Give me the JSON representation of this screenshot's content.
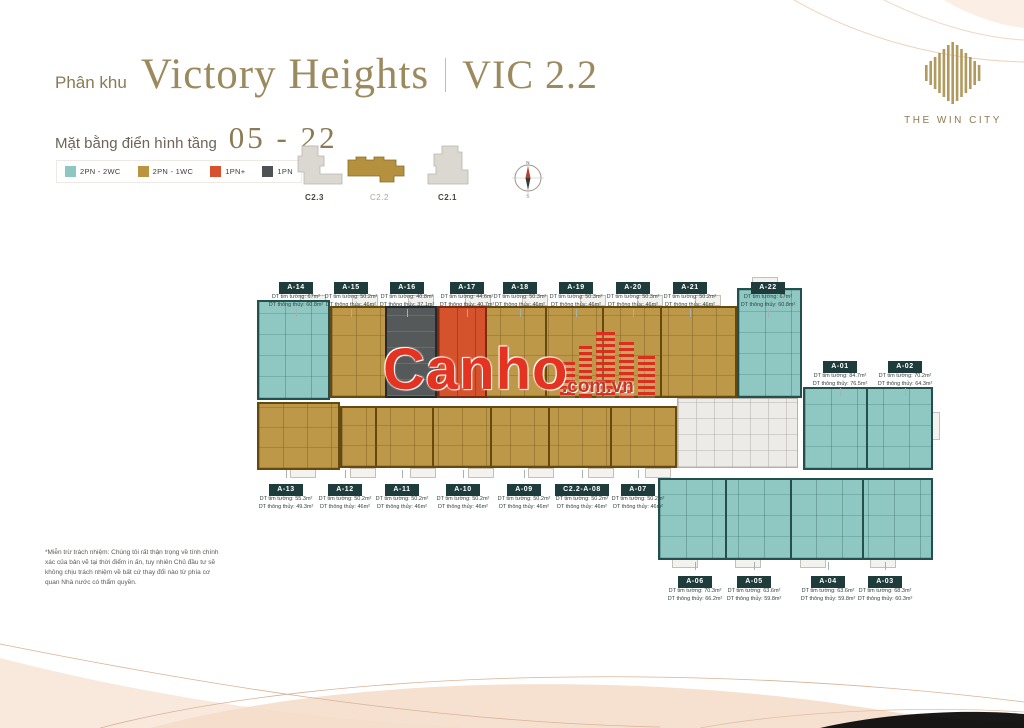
{
  "header": {
    "prefix": "Phân khu",
    "title": "Victory Heights",
    "sep": "|",
    "code": "VIC 2.2",
    "sub_label": "Mặt bằng điển hình tầng",
    "sub_value": "05 - 22"
  },
  "logo": {
    "title": "THE WIN CITY"
  },
  "legend": [
    {
      "label": "2PN - 2WC",
      "color": "#8ec6c1"
    },
    {
      "label": "2PN - 1WC",
      "color": "#bb9440"
    },
    {
      "label": "1PN+",
      "color": "#d9512c"
    },
    {
      "label": "1PN",
      "color": "#4e5253"
    }
  ],
  "keyplan": {
    "blocks": [
      {
        "label": "C2.3",
        "active": false
      },
      {
        "label": "C2.2",
        "active": true
      },
      {
        "label": "C2.1",
        "active": false
      }
    ]
  },
  "compass": {
    "n": "N",
    "s": "S"
  },
  "watermark": {
    "brand": "Canho",
    "suffix": ".com.vn"
  },
  "disclaimer": "*Miễn trừ trách nhiệm: Chúng tôi rất thận trọng về tính chính xác của bản vẽ tại thời điểm in ấn, tuy nhiên Chủ đầu tư sẽ không chịu trách nhiệm về bất cứ thay đổi nào từ phía cơ quan Nhà nước có thẩm quyền.",
  "units": [
    {
      "name": "A-14",
      "type": "2PN - 2WC",
      "area_wall": "DT tim tường: 67m²",
      "area_clear": "DT thông thủy: 60.8m²",
      "x": 296,
      "y": 276,
      "dir": "down"
    },
    {
      "name": "A-15",
      "type": "2PN - 1WC",
      "area_wall": "DT tim tường: 50.2m²",
      "area_clear": "DT thông thủy: 46m²",
      "x": 351,
      "y": 276,
      "dir": "down"
    },
    {
      "name": "A-16",
      "type": "1PN",
      "area_wall": "DT tim tường: 40.8m²",
      "area_clear": "DT thông thủy: 37.1m²",
      "x": 407,
      "y": 276,
      "dir": "down"
    },
    {
      "name": "A-17",
      "type": "1PN+",
      "area_wall": "DT tim tường: 44.6m²",
      "area_clear": "DT thông thủy: 40.7m²",
      "x": 467,
      "y": 276,
      "dir": "down"
    },
    {
      "name": "A-18",
      "type": "2PN - 1WC",
      "area_wall": "DT tim tường: 50.3m²",
      "area_clear": "DT thông thủy: 46m²",
      "x": 520,
      "y": 276,
      "dir": "down"
    },
    {
      "name": "A-19",
      "type": "2PN - 1WC",
      "area_wall": "DT tim tường: 50.3m²",
      "area_clear": "DT thông thủy: 46m²",
      "x": 576,
      "y": 276,
      "dir": "down"
    },
    {
      "name": "A-20",
      "type": "2PN - 1WC",
      "area_wall": "DT tim tường: 50.3m²",
      "area_clear": "DT thông thủy: 46m²",
      "x": 633,
      "y": 276,
      "dir": "down"
    },
    {
      "name": "A-21",
      "type": "2PN - 1WC",
      "area_wall": "DT tim tường: 50.2m²",
      "area_clear": "DT thông thủy: 46m²",
      "x": 690,
      "y": 276,
      "dir": "down"
    },
    {
      "name": "A-22",
      "type": "2PN - 2WC",
      "area_wall": "DT tim tường: 67m²",
      "area_clear": "DT thông thủy: 60.8m²",
      "x": 768,
      "y": 276,
      "dir": "down"
    },
    {
      "name": "A-01",
      "type": "2PN - 2WC",
      "area_wall": "DT tim tường: 84.7m²",
      "area_clear": "DT thông thủy: 76.5m²",
      "x": 840,
      "y": 355,
      "dir": "down"
    },
    {
      "name": "A-02",
      "type": "2PN - 2WC",
      "area_wall": "DT tim tường: 70.2m²",
      "area_clear": "DT thông thủy: 64.3m²",
      "x": 905,
      "y": 355,
      "dir": "down"
    },
    {
      "name": "A-13",
      "type": "2PN - 1WC",
      "area_wall": "DT tim tường: 55.3m²",
      "area_clear": "DT thông thủy: 49.3m²",
      "x": 286,
      "y": 478,
      "dir": "up"
    },
    {
      "name": "A-12",
      "type": "2PN - 1WC",
      "area_wall": "DT tim tường: 50.2m²",
      "area_clear": "DT thông thủy: 46m²",
      "x": 345,
      "y": 478,
      "dir": "up"
    },
    {
      "name": "A-11",
      "type": "2PN - 1WC",
      "area_wall": "DT tim tường: 50.2m²",
      "area_clear": "DT thông thủy: 46m²",
      "x": 402,
      "y": 478,
      "dir": "up"
    },
    {
      "name": "A-10",
      "type": "2PN - 1WC",
      "area_wall": "DT tim tường: 50.2m²",
      "area_clear": "DT thông thủy: 46m²",
      "x": 463,
      "y": 478,
      "dir": "up"
    },
    {
      "name": "A-09",
      "type": "2PN - 1WC",
      "area_wall": "DT tim tường: 50.2m²",
      "area_clear": "DT thông thủy: 46m²",
      "x": 524,
      "y": 478,
      "dir": "up"
    },
    {
      "name": "C2.2-A-08",
      "type": "2PN - 1WC",
      "area_wall": "DT tim tường: 50.2m²",
      "area_clear": "DT thông thủy: 46m²",
      "x": 582,
      "y": 478,
      "dir": "up"
    },
    {
      "name": "A-07",
      "type": "2PN - 1WC",
      "area_wall": "DT tim tường: 50.2m²",
      "area_clear": "DT thông thủy: 46m²",
      "x": 638,
      "y": 478,
      "dir": "up"
    },
    {
      "name": "A-06",
      "type": "2PN - 2WC",
      "area_wall": "DT tim tường: 70.3m²",
      "area_clear": "DT thông thủy: 66.2m²",
      "x": 695,
      "y": 570,
      "dir": "up"
    },
    {
      "name": "A-05",
      "type": "2PN - 2WC",
      "area_wall": "DT tim tường: 63.6m²",
      "area_clear": "DT thông thủy: 59.8m²",
      "x": 754,
      "y": 570,
      "dir": "up"
    },
    {
      "name": "A-04",
      "type": "2PN - 2WC",
      "area_wall": "DT tim tường: 63.6m²",
      "area_clear": "DT thông thủy: 59.8m²",
      "x": 828,
      "y": 570,
      "dir": "up"
    },
    {
      "name": "A-03",
      "type": "2PN - 2WC",
      "area_wall": "DT tim tường: 68.3m²",
      "area_clear": "DT thông thủy: 60.3m²",
      "x": 885,
      "y": 570,
      "dir": "up"
    }
  ],
  "blocks": [
    {
      "t": "balc",
      "x": 300,
      "y": 295,
      "w": 26,
      "h": 11
    },
    {
      "t": "balc",
      "x": 352,
      "y": 295,
      "w": 26,
      "h": 11
    },
    {
      "t": "balc",
      "x": 408,
      "y": 295,
      "w": 26,
      "h": 11
    },
    {
      "t": "balc",
      "x": 465,
      "y": 295,
      "w": 26,
      "h": 11
    },
    {
      "t": "balc",
      "x": 522,
      "y": 295,
      "w": 26,
      "h": 11
    },
    {
      "t": "balc",
      "x": 580,
      "y": 295,
      "w": 26,
      "h": 11
    },
    {
      "t": "balc",
      "x": 637,
      "y": 295,
      "w": 26,
      "h": 11
    },
    {
      "t": "balc",
      "x": 695,
      "y": 295,
      "w": 26,
      "h": 11
    },
    {
      "t": "balc",
      "x": 752,
      "y": 277,
      "w": 26,
      "h": 11
    },
    {
      "t": "balc",
      "x": 290,
      "y": 468,
      "w": 26,
      "h": 10
    },
    {
      "t": "balc",
      "x": 350,
      "y": 468,
      "w": 26,
      "h": 10
    },
    {
      "t": "balc",
      "x": 410,
      "y": 468,
      "w": 26,
      "h": 10
    },
    {
      "t": "balc",
      "x": 468,
      "y": 468,
      "w": 26,
      "h": 10
    },
    {
      "t": "balc",
      "x": 528,
      "y": 468,
      "w": 26,
      "h": 10
    },
    {
      "t": "balc",
      "x": 588,
      "y": 468,
      "w": 26,
      "h": 10
    },
    {
      "t": "balc",
      "x": 645,
      "y": 468,
      "w": 26,
      "h": 10
    },
    {
      "t": "balc",
      "x": 672,
      "y": 558,
      "w": 26,
      "h": 10
    },
    {
      "t": "balc",
      "x": 735,
      "y": 558,
      "w": 26,
      "h": 10
    },
    {
      "t": "balc",
      "x": 800,
      "y": 558,
      "w": 26,
      "h": 10
    },
    {
      "t": "balc",
      "x": 870,
      "y": 558,
      "w": 26,
      "h": 10
    },
    {
      "t": "balc",
      "x": 931,
      "y": 412,
      "w": 9,
      "h": 28
    },
    {
      "t": "teal",
      "x": 257,
      "y": 300,
      "w": 73,
      "h": 100
    },
    {
      "t": "gold",
      "x": 330,
      "y": 306,
      "w": 407,
      "h": 92
    },
    {
      "t": "gray",
      "x": 385,
      "y": 306,
      "w": 52,
      "h": 92
    },
    {
      "t": "orange",
      "x": 437,
      "y": 306,
      "w": 50,
      "h": 92
    },
    {
      "t": "teal",
      "x": 737,
      "y": 288,
      "w": 65,
      "h": 110
    },
    {
      "t": "gold",
      "x": 257,
      "y": 402,
      "w": 83,
      "h": 68
    },
    {
      "t": "gold",
      "x": 340,
      "y": 406,
      "w": 337,
      "h": 62
    },
    {
      "t": "core",
      "x": 677,
      "y": 398,
      "w": 121,
      "h": 70
    },
    {
      "t": "teal",
      "x": 803,
      "y": 387,
      "w": 130,
      "h": 83
    },
    {
      "t": "teal",
      "x": 658,
      "y": 478,
      "w": 275,
      "h": 82
    },
    {
      "t": "wallg",
      "x": 545,
      "y": 306,
      "w": 2,
      "h": 92
    },
    {
      "t": "wallg",
      "x": 602,
      "y": 306,
      "w": 2,
      "h": 92
    },
    {
      "t": "wallg",
      "x": 660,
      "y": 306,
      "w": 2,
      "h": 92
    },
    {
      "t": "wallg",
      "x": 375,
      "y": 406,
      "w": 2,
      "h": 62
    },
    {
      "t": "wallg",
      "x": 432,
      "y": 406,
      "w": 2,
      "h": 62
    },
    {
      "t": "wallg",
      "x": 490,
      "y": 406,
      "w": 2,
      "h": 62
    },
    {
      "t": "wallg",
      "x": 548,
      "y": 406,
      "w": 2,
      "h": 62
    },
    {
      "t": "wallg",
      "x": 610,
      "y": 406,
      "w": 2,
      "h": 62
    },
    {
      "t": "wallt",
      "x": 866,
      "y": 387,
      "w": 2,
      "h": 83
    },
    {
      "t": "wallt",
      "x": 725,
      "y": 478,
      "w": 2,
      "h": 82
    },
    {
      "t": "wallt",
      "x": 790,
      "y": 478,
      "w": 2,
      "h": 82
    },
    {
      "t": "wallt",
      "x": 862,
      "y": 478,
      "w": 2,
      "h": 82
    }
  ]
}
